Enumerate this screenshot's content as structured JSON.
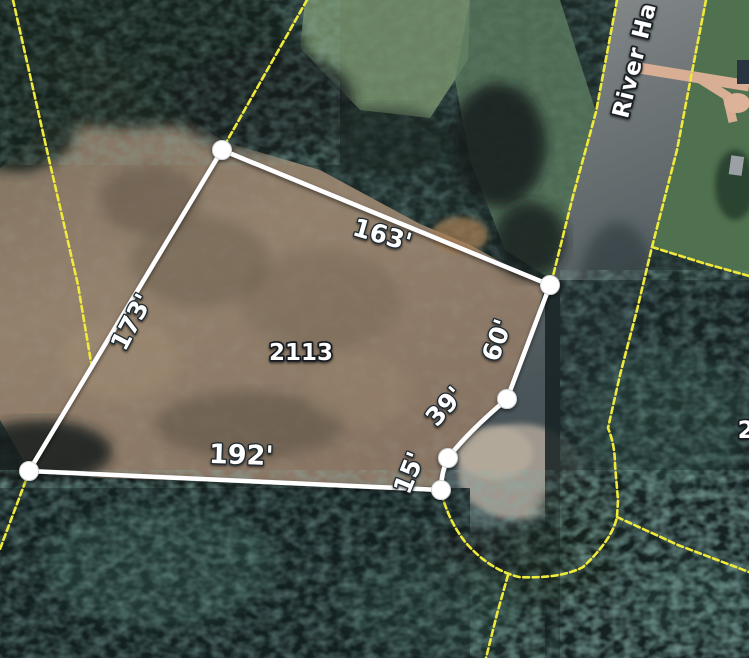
{
  "map": {
    "view_type": "satellite-parcel-view",
    "street": {
      "label": "River Ha"
    },
    "selected_parcel": {
      "number": "2113",
      "edges": [
        {
          "side": "top",
          "length": "163'"
        },
        {
          "side": "left",
          "length": "173'"
        },
        {
          "side": "bottom",
          "length": "192'"
        },
        {
          "side": "right_upper",
          "length": "60'"
        },
        {
          "side": "cul_de_sac_arc",
          "length": "39'"
        },
        {
          "side": "cul_de_sac_low",
          "length": "15'"
        }
      ]
    },
    "neighbor_parcel": {
      "partial_number": "2"
    },
    "colors": {
      "parcel_outline": "#ffffff",
      "lot_line_yellow": "#efe93b",
      "dirt": "#8d7c68",
      "forest": "#1b2927",
      "road": "#83878a",
      "lawn": "#4f6e51",
      "path": "#d8ae94"
    }
  }
}
